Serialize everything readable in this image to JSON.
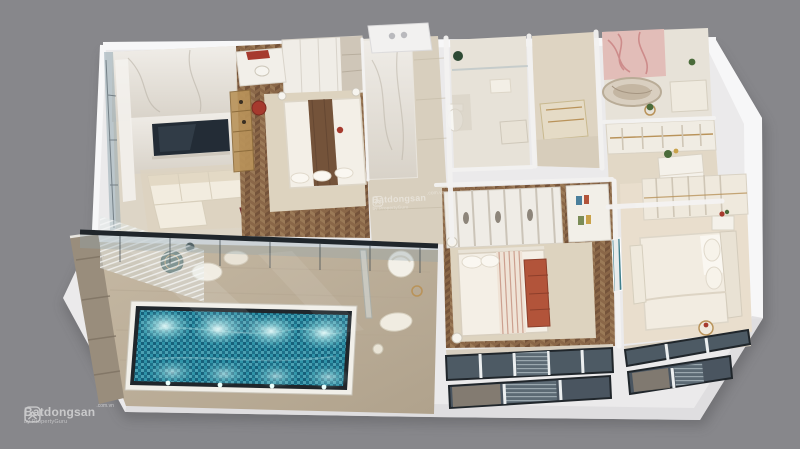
{
  "watermark": {
    "brand": "Batdongsan",
    "suffix": ".com.vn",
    "byline": "by PropertyGuru"
  },
  "center_watermark": {
    "brand": "Batdongsan",
    "suffix": ".com.vn",
    "byline": "by PropertyGuru"
  },
  "icons": {
    "watermark_logo": "house-chevrons-in-rounded-square"
  },
  "colors": {
    "bg": "#87878b",
    "slab": "#ebeaeb",
    "slabBright": "#f7f7f8",
    "slabShade": "#dcdbdd",
    "wall": "#f3f2f1",
    "marbleWall": "#e9e5de",
    "marbleFloor": "#ddd5c6",
    "marbleHall": "#d8cfbe",
    "bathFloor": "#e7e2d8",
    "wood": "#8a6748",
    "woodDark": "#74533a",
    "woodLight": "#9b7a57",
    "rug": "#ddd3bf",
    "cream": "#f2ecdf",
    "sofaShade": "#e3d9c5",
    "deck": "#c5b8a3",
    "deckDark": "#b0a28c",
    "stone": "#998d7c",
    "poolDeep": "#1d7089",
    "poolMid": "#2f93a8",
    "poolLight": "#6ec6d2",
    "frame": "#20262b",
    "glass": "#93a7b0",
    "glassDark": "#4d5a64",
    "tv": "#232c36",
    "gold": "#b9935a",
    "terracotta": "#b2543a",
    "red": "#a63a2e",
    "wine": "#8e3a3c",
    "teal": "#2f4f4a",
    "artTeal": "#3f7f8c",
    "pink": "#e2bdb8",
    "pinkVein": "#c87f7f",
    "plant": "#4a6b3a"
  }
}
